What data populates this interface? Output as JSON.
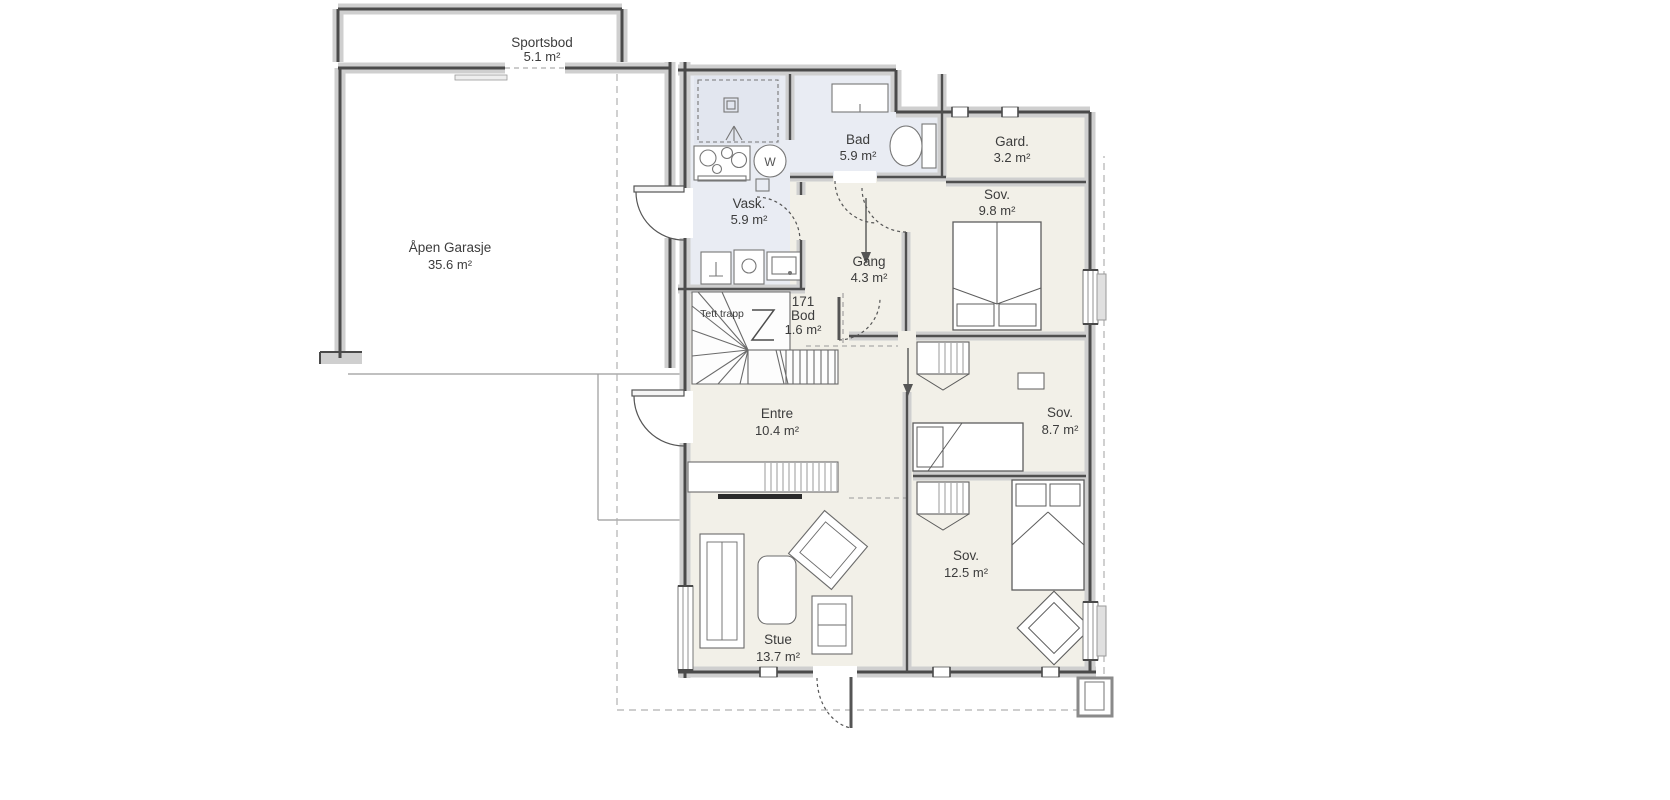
{
  "plan": {
    "rooms": {
      "sportsbod": {
        "name": "Sportsbod",
        "area": "5.1 m²"
      },
      "garasje": {
        "name": "Åpen Garasje",
        "area": "35.6 m²"
      },
      "vask": {
        "name": "Vask.",
        "area": "5.9 m²"
      },
      "bad": {
        "name": "Bad",
        "area": "5.9 m²"
      },
      "gard": {
        "name": "Gard.",
        "area": "3.2 m²"
      },
      "sov_nord": {
        "name": "Sov.",
        "area": "9.8 m²"
      },
      "gang": {
        "name": "Gang",
        "area": "4.3 m²"
      },
      "bod": {
        "number": "171",
        "name": "Bod",
        "area": "1.6 m²"
      },
      "trapp": {
        "label": "Tett trapp"
      },
      "entre": {
        "name": "Entre",
        "area": "10.4 m²"
      },
      "sov_midt": {
        "name": "Sov.",
        "area": "8.7 m²"
      },
      "sov_sor": {
        "name": "Sov.",
        "area": "12.5 m²"
      },
      "stue": {
        "name": "Stue",
        "area": "13.7 m²"
      }
    },
    "symbols": {
      "water_heater": "W"
    },
    "colors": {
      "wall": "#4a4a4a",
      "wall_band": "#cfcfcf",
      "floor_living": "#f2f0e8",
      "floor_wet": "#e9ecf3",
      "floor_white": "#ffffff",
      "furniture_line": "#6f6f6f",
      "dashed_line": "#aaaaaa"
    }
  }
}
